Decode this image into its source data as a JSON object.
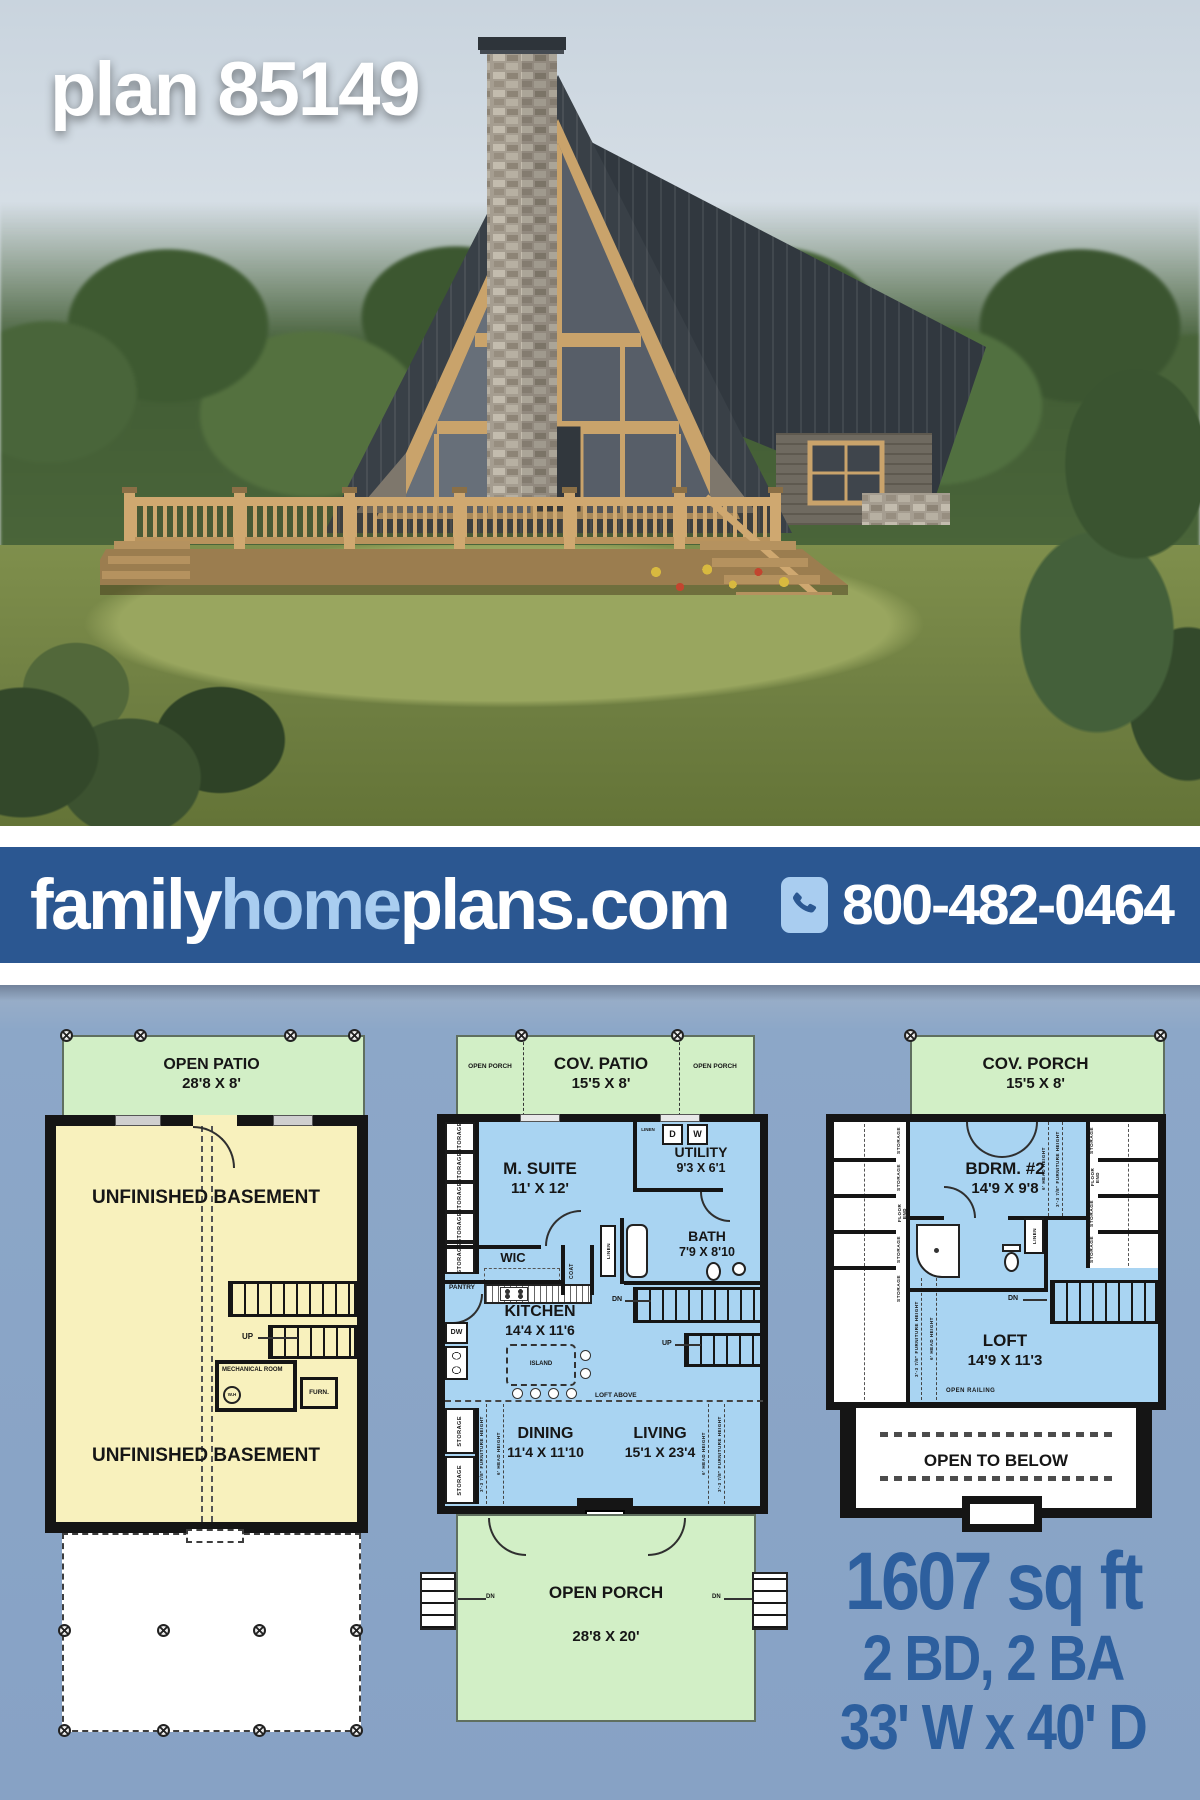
{
  "hero": {
    "plan_title": "plan 85149"
  },
  "banner": {
    "brand_family": "family",
    "brand_home": "home",
    "brand_plans": "plans.com",
    "phone": "800-482-0464"
  },
  "stats": {
    "sqft": "1607 sq ft",
    "bed_bath": "2 BD, 2 BA",
    "footprint": "33' W x 40' D"
  },
  "colors": {
    "banner_blue": "#2b5791",
    "brand_light_blue": "#a9cdf0",
    "stats_blue": "#2d5f9e",
    "background_blue_gray": "#8ca7c8",
    "patio_green": "#d2efc6",
    "basement_yellow": "#f8f1bd",
    "floor_blue": "#a9d4f2",
    "wall_black": "#151515"
  },
  "basement_plan": {
    "patio_name": "OPEN PATIO",
    "patio_dims": "28'8 X 8'",
    "upper_room": "UNFINISHED BASEMENT",
    "lower_room": "UNFINISHED BASEMENT",
    "mechanical": "MECHANICAL ROOM",
    "water_heater": "W.H",
    "furnace": "FURN.",
    "up": "UP"
  },
  "main_plan": {
    "patio_name": "COV. PATIO",
    "patio_dims": "15'5 X 8'",
    "patio_left_porch": "OPEN PORCH",
    "patio_right_porch": "OPEN PORCH",
    "master": "M. SUITE",
    "master_dims": "11' X 12'",
    "utility": "UTILITY",
    "utility_dims": "9'3 X 6'1",
    "dryer": "D",
    "washer": "W",
    "linen": "LINEN",
    "wic": "WIC",
    "coat": "COAT",
    "bath": "BATH",
    "bath_dims": "7'9 X 8'10",
    "pantry": "PANTRY",
    "dw": "DW",
    "kitchen": "KITCHEN",
    "kitchen_dims": "14'4 X 11'6",
    "island": "ISLAND",
    "dn": "DN",
    "up": "UP",
    "loft_above": "LOFT ABOVE",
    "dining": "DINING",
    "dining_dims": "11'4 X 11'10",
    "living": "LIVING",
    "living_dims": "15'1 X 23'4",
    "porch_name": "OPEN PORCH",
    "porch_dims": "28'8 X 20'",
    "storage": "STORAGE",
    "furniture_height": "3'-3 7/8\" FURNITURE HEIGHT",
    "head_height": "6' HEAD HEIGHT"
  },
  "upper_plan": {
    "porch_name": "COV. PORCH",
    "porch_dims": "15'5 X 8'",
    "bedroom2": "BDRM. #2",
    "bedroom2_dims": "14'9 X 9'8",
    "loft": "LOFT",
    "loft_dims": "14'9 X 11'3",
    "open_railing": "OPEN RAILING",
    "open_to_below": "OPEN TO BELOW",
    "dn": "DN",
    "linen": "LINEN",
    "storage": "STORAGE",
    "floor_end": "FLOOR END",
    "furniture_height": "3'-3 7/8\" FURNITURE HEIGHT",
    "head_height": "6' HEAD HEIGHT"
  }
}
